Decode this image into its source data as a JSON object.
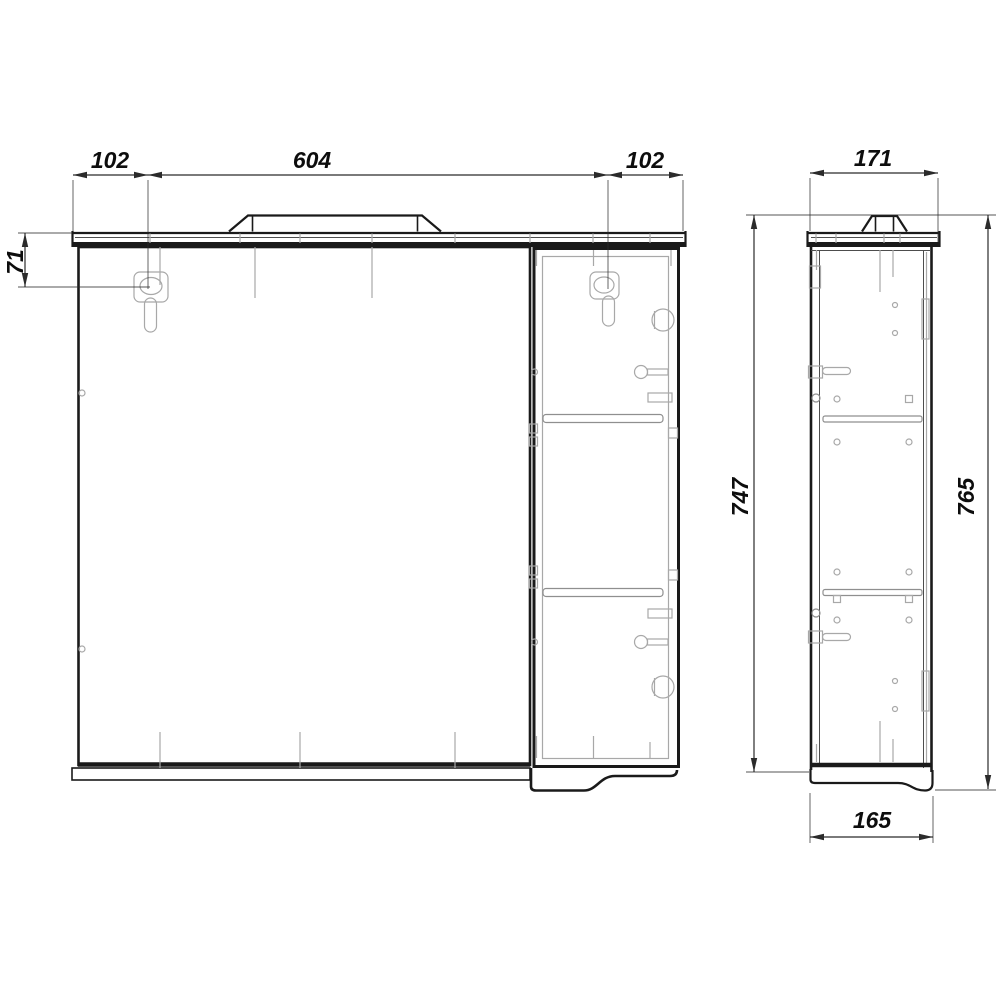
{
  "colors": {
    "background": "#ffffff",
    "outline": "#1a1a1a",
    "mid_line": "#4d4d4d",
    "light_detail": "#a8a8a8",
    "medium_detail": "#8f8f8f",
    "dimension_line": "#2b2b2b",
    "text": "#0d0d0d"
  },
  "labels": {
    "front_width_left": "102",
    "front_width_center": "604",
    "front_width_right": "102",
    "hanger_offset_vertical": "71",
    "side_depth_top": "171",
    "side_height_body": "747",
    "side_height_total": "765",
    "side_depth_bottom": "165"
  }
}
